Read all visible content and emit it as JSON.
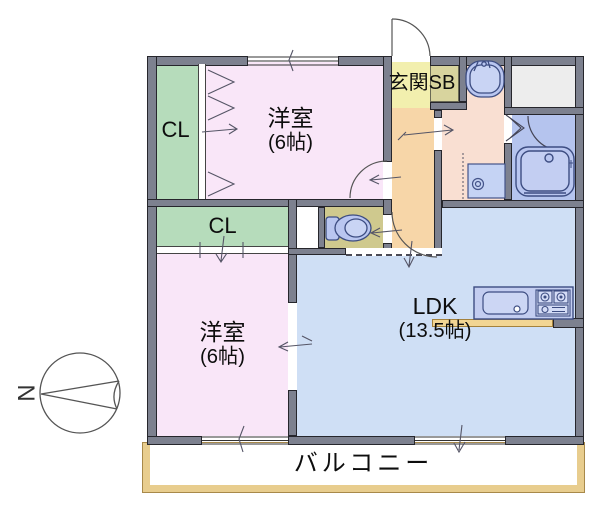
{
  "plan": {
    "rooms": {
      "bedroom_top": {
        "label": "洋室",
        "size": "(6帖)"
      },
      "bedroom_bottom": {
        "label": "洋室",
        "size": "(6帖)"
      },
      "ldk": {
        "label": "LDK",
        "size": "(13.5帖)"
      },
      "closet_top": {
        "label": "CL"
      },
      "closet_middle": {
        "label": "CL"
      },
      "entrance": {
        "label": "玄関SB"
      },
      "balcony": {
        "label": "バルコニー"
      }
    },
    "compass": {
      "north_label": "N"
    },
    "fixtures": [
      "entrance-door",
      "toilet",
      "washbasin",
      "bathtub",
      "washing-machine-pan",
      "kitchen-sink",
      "gas-stove",
      "kitchen-counter"
    ],
    "colors": {
      "wall": "#7d818f",
      "bedroom_floor": "#f9e6f8",
      "closet_floor": "#b6dcbb",
      "ldk_floor": "#cfdff5",
      "entrance_floor": "#f2efae",
      "shoebox": "#d8d49e",
      "hallway_floor": "#f7d6a8",
      "washroom_floor": "#f9dfd2",
      "bathroom_floor": "#b5c4ee",
      "toilet_floor": "#cfc98e",
      "fixture_fill": "#b9c6f0",
      "counter_strip": "#f2d593",
      "balcony_edge": "#e8cd8e",
      "storage_fill": "#ededed"
    }
  }
}
